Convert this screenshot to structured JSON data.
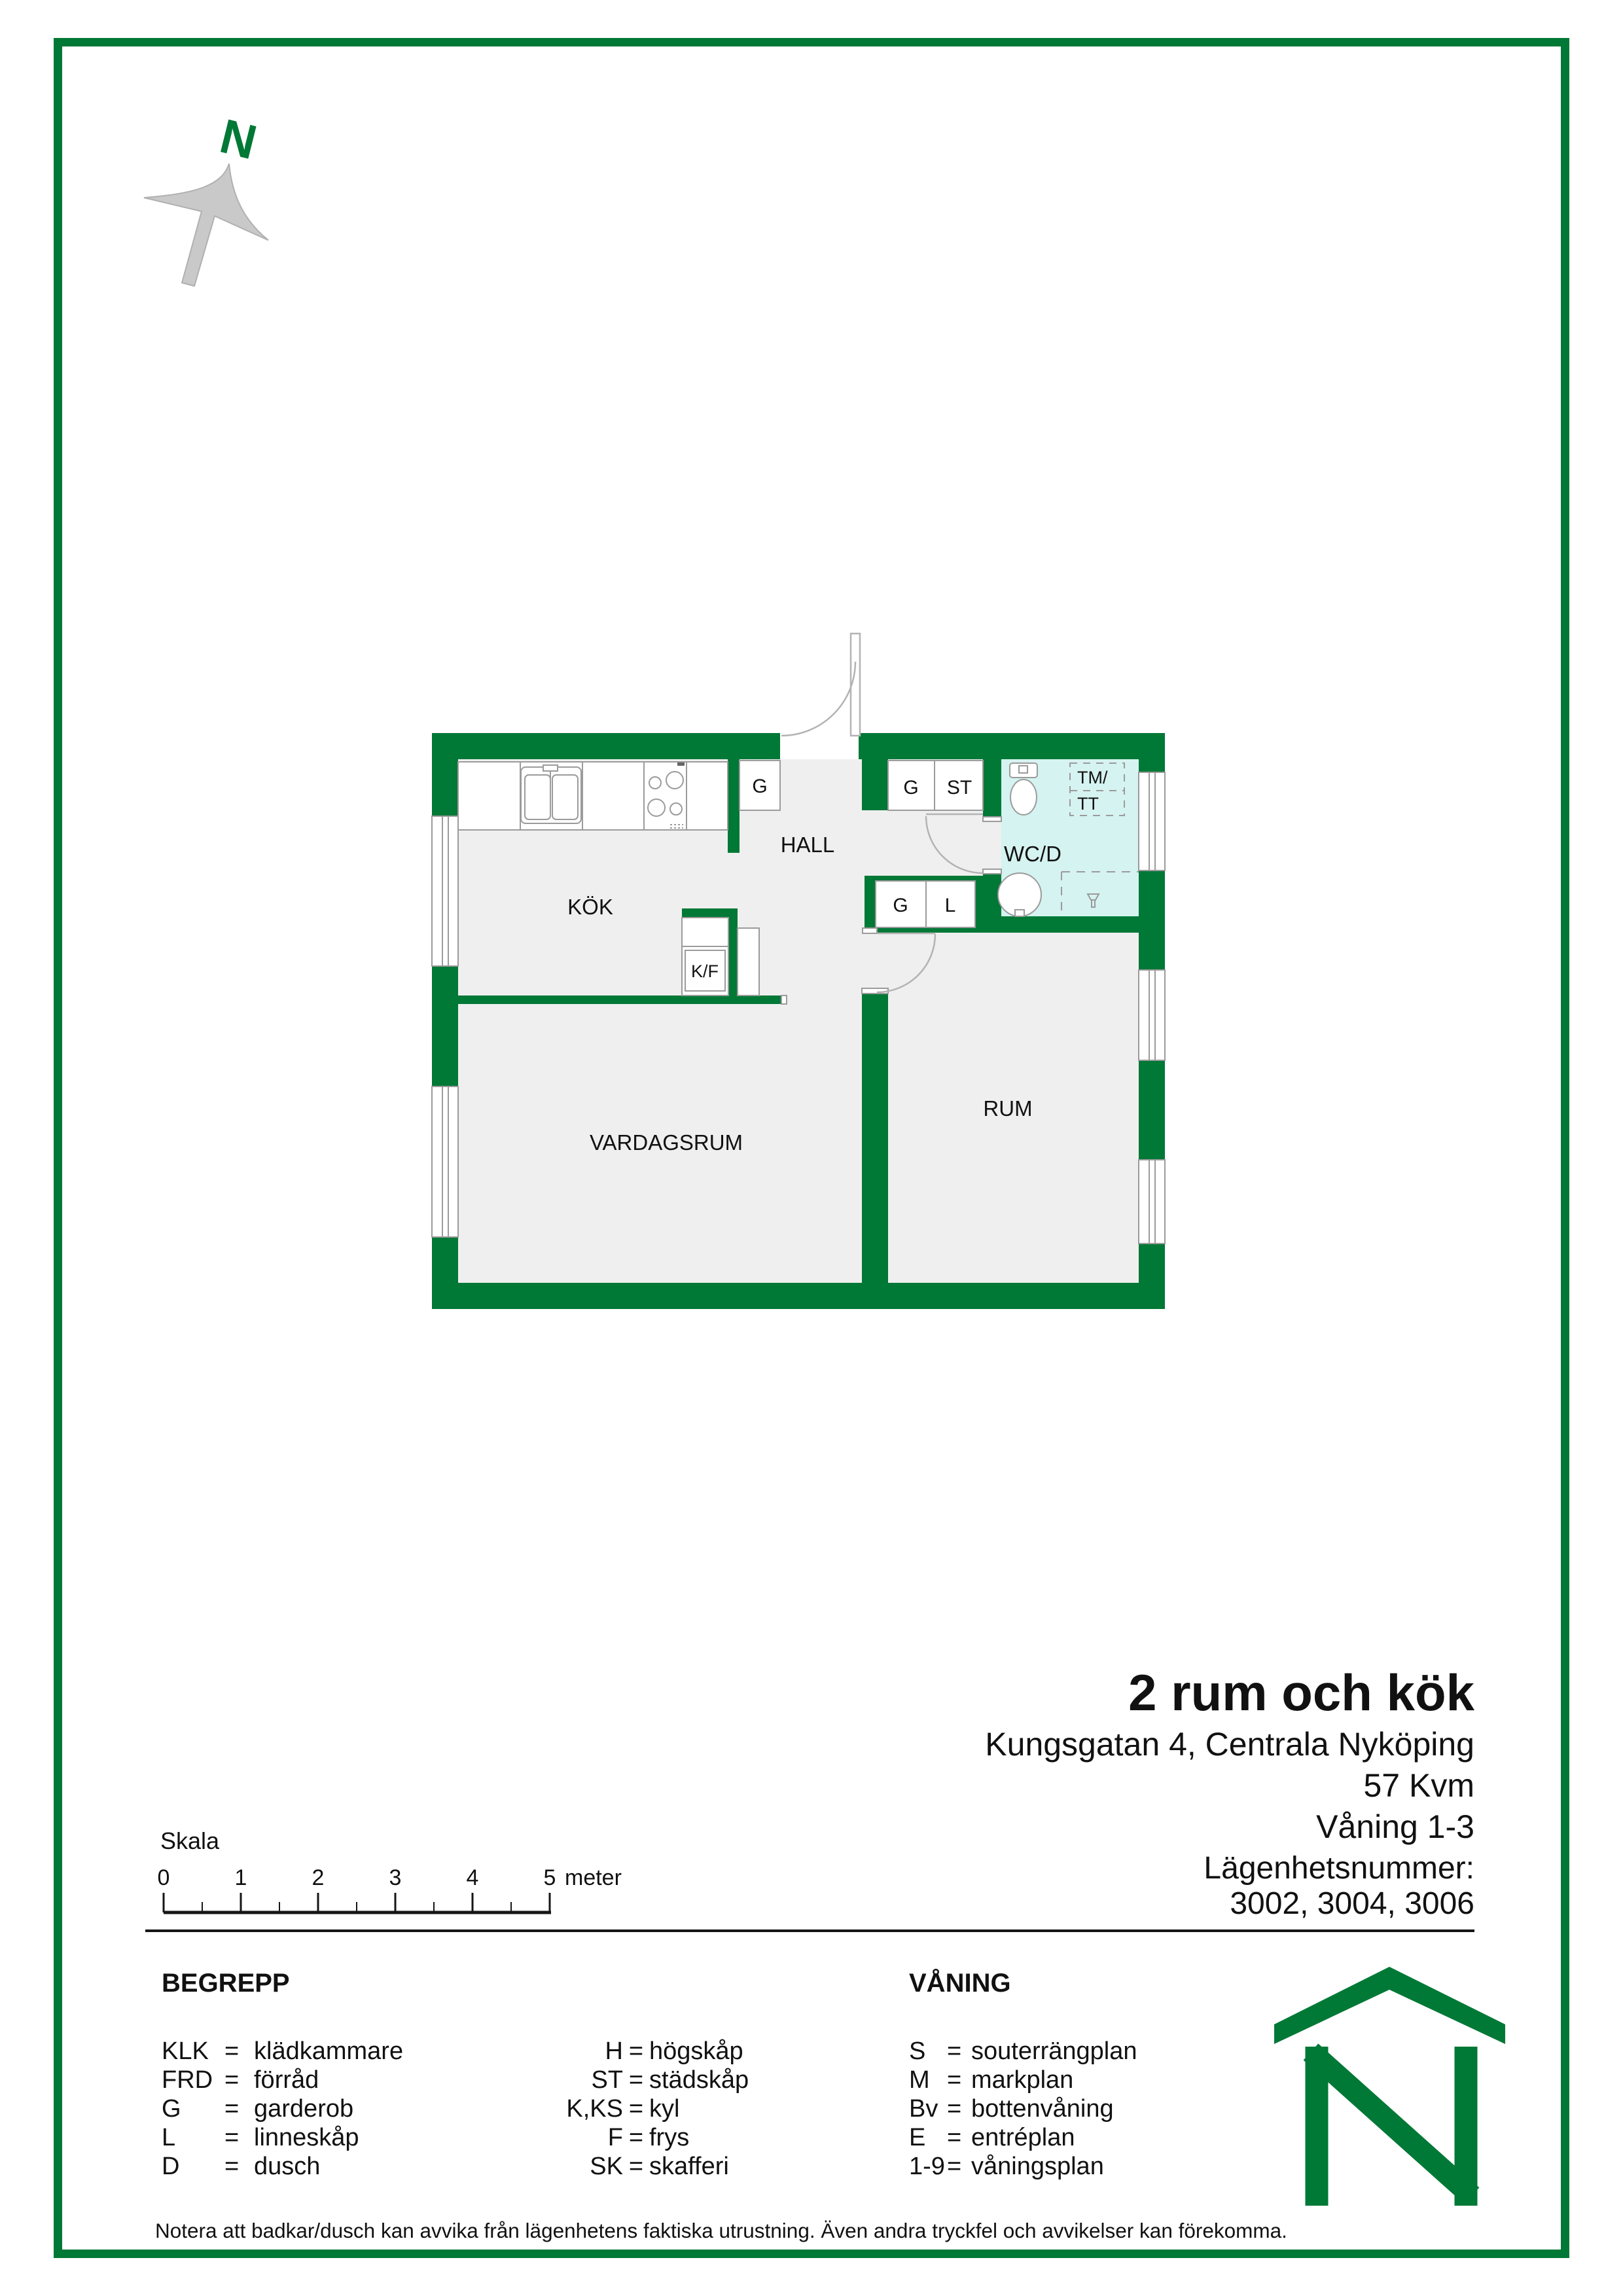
{
  "compass": {
    "letter": "N"
  },
  "floorplan": {
    "rooms": {
      "kitchen": "KÖK",
      "hall": "HALL",
      "wc": "WC/D",
      "room": "RUM",
      "living_room": "VARDAGSRUM"
    },
    "fixtures": {
      "wardrobe_kitchen": "G",
      "wardrobe_hall_top": "G",
      "cleaning_closet": "ST",
      "wardrobe_hall_lower": "G",
      "linen_closet": "L",
      "fridge_freezer": "K/F",
      "washer_line1": "TM/",
      "washer_line2": "TT"
    }
  },
  "title_block": {
    "title": "2 rum och kök",
    "address": "Kungsgatan 4, Centrala Nyköping",
    "area": "57 Kvm",
    "floors": "Våning 1-3"
  },
  "apartment_numbers": {
    "label": "Lägenhetsnummer:",
    "numbers": "3002, 3004, 3006"
  },
  "scale_bar": {
    "label": "Skala",
    "ticks": [
      "0",
      "1",
      "2",
      "3",
      "4",
      "5"
    ],
    "unit": "meter"
  },
  "legend": {
    "eq": "=",
    "begrepp": {
      "heading": "BEGREPP",
      "col1": [
        {
          "abbr": "KLK",
          "def": "klädkammare"
        },
        {
          "abbr": "FRD",
          "def": "förråd"
        },
        {
          "abbr": "G",
          "def": "garderob"
        },
        {
          "abbr": "L",
          "def": "linneskåp"
        },
        {
          "abbr": "D",
          "def": "dusch"
        }
      ],
      "col2": [
        {
          "abbr": "H",
          "def": "högskåp"
        },
        {
          "abbr": "ST",
          "def": "städskåp"
        },
        {
          "abbr": "K,KS",
          "def": "kyl"
        },
        {
          "abbr": "F",
          "def": "frys"
        },
        {
          "abbr": "SK",
          "def": "skafferi"
        }
      ]
    },
    "vaning": {
      "heading": "VÅNING",
      "rows": [
        {
          "abbr": "S",
          "def": "souterrängplan"
        },
        {
          "abbr": "M",
          "def": "markplan"
        },
        {
          "abbr": "Bv",
          "def": "bottenvåning"
        },
        {
          "abbr": "E",
          "def": "entréplan"
        },
        {
          "abbr": "1-9",
          "def": "våningsplan"
        }
      ]
    }
  },
  "footer": {
    "note": "Notera att badkar/dusch kan avvika från lägenhetens faktiska utrustning. Även andra tryckfel och avvikelser kan förekomma."
  },
  "colors": {
    "wall_green": "#007836",
    "wc_floor_cyan": "#d5f3f0",
    "floor_gray": "#efefef",
    "outline_gray": "#9b9b9b"
  }
}
